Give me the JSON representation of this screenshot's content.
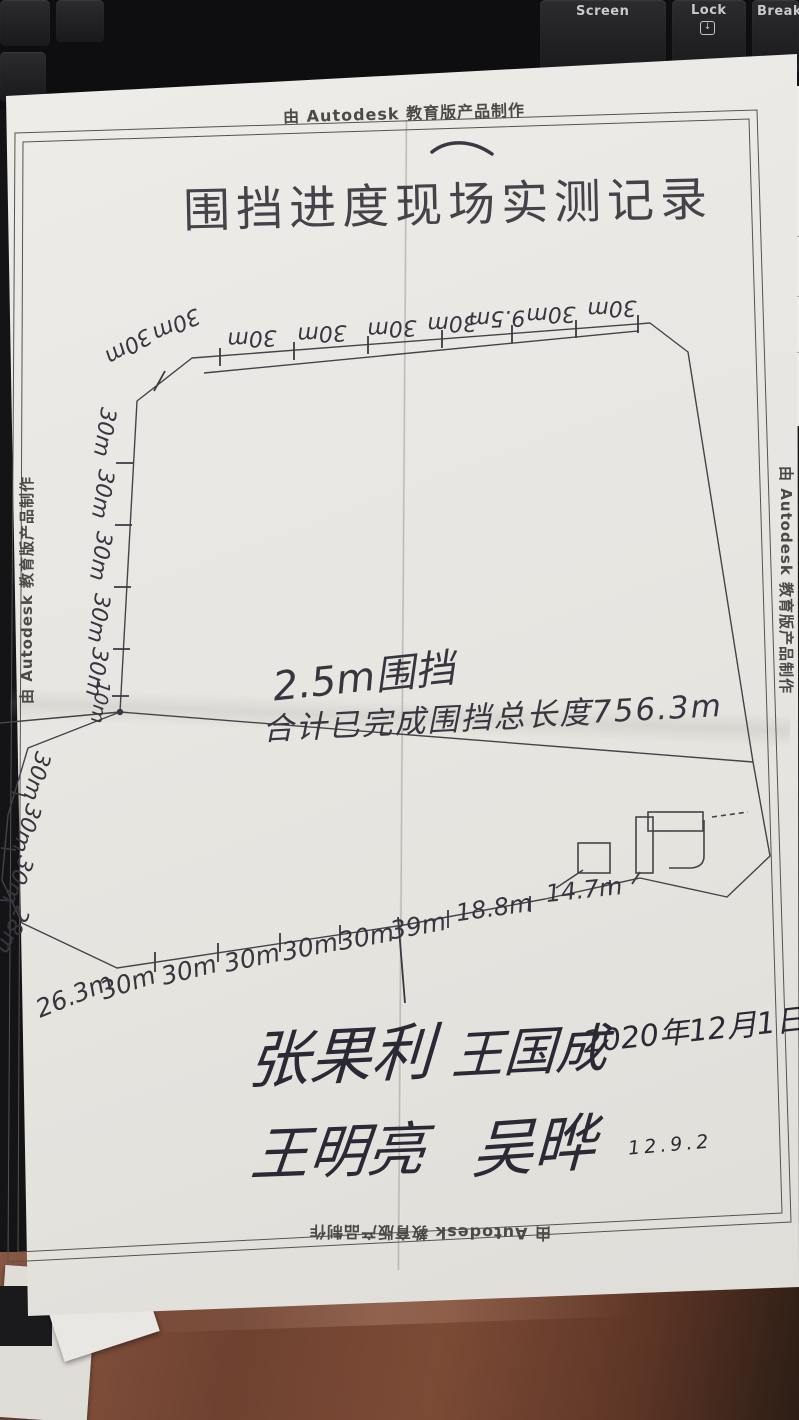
{
  "keyboard": {
    "keys": [
      {
        "label": "Screen"
      },
      {
        "label": "Lock",
        "icon": "boxed-down-arrow"
      },
      {
        "label": "Break"
      }
    ]
  },
  "paper": {
    "credit_top": "由 Autodesk 教育版产品制作",
    "credit_bottom": "由 Autodesk 教育版产品制作",
    "credit_left": "由 Autodesk 教育版产品制作",
    "credit_right": "由 Autodesk 教育版产品制作",
    "title": "围挡进度现场实测记录",
    "note_line1": "2.5m围挡",
    "note_line2": "合计已完成围挡总长度756.3m",
    "m": {
      "corner": [
        "30m",
        "30m"
      ],
      "top": [
        "30m",
        "30m",
        "30m",
        "30m",
        "9.5m",
        "30m",
        "30m"
      ],
      "left": [
        "30m",
        "30m",
        "30m",
        "30m",
        "30m",
        "10m"
      ],
      "lowerleft": [
        "30m",
        "30m",
        "30m",
        "28m"
      ],
      "bottom": [
        "26.3m",
        "30m",
        "30m",
        "30m",
        "30m",
        "30m",
        "39m",
        "18.8m",
        "14.7m"
      ]
    },
    "sig": {
      "name1": "张果利",
      "name2": "王国成",
      "date": "2020年12月1日",
      "name3": "王明亮",
      "name4": "吴晔",
      "small_note": "12.9.2"
    },
    "side_sheet": [
      "注",
      "向"
    ]
  }
}
